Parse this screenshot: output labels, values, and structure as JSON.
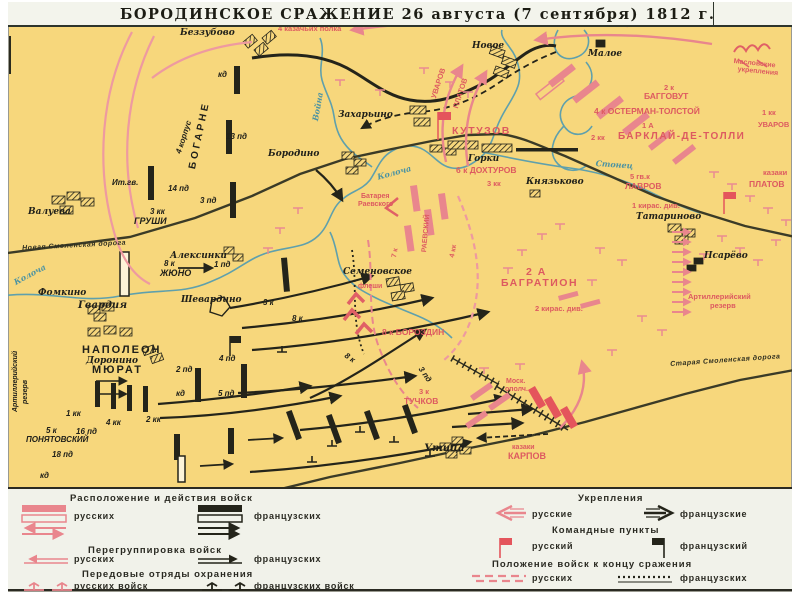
{
  "title": "БОРОДИНСКОЕ СРАЖЕНИЕ   26 августа (7 сентября) 1812 г.",
  "colors": {
    "map_background": "#f7d77c",
    "russian_pink": "#e9868d",
    "russian_red_text": "#dd5a60",
    "french_black": "#24241a",
    "river_blue": "#5fa0ac"
  },
  "legend": {
    "left": {
      "h1": "Расположение и действия войск",
      "rus1": "русских",
      "fr1": "французских",
      "h2": "Перегруппировка войск",
      "rus2": "русских",
      "fr2": "французских",
      "h3": "Передовые отряды охранения",
      "rus3": "русских войск",
      "fr3": "французских войск"
    },
    "right": {
      "h1": "Укрепления",
      "rus1": "русские",
      "fr1": "французские",
      "h2": "Командные пункты",
      "rus2": "русский",
      "fr2": "французский",
      "h3": "Положение войск к концу сражения",
      "rus3": "русских",
      "fr3": "французских"
    }
  },
  "map_labels": [
    {
      "t": "Беззубово",
      "x": 180,
      "y": 28,
      "c": "v"
    },
    {
      "t": "Новое",
      "x": 472,
      "y": 41,
      "c": "v"
    },
    {
      "t": "Малое",
      "x": 588,
      "y": 49,
      "c": "v"
    },
    {
      "t": "Захарьино",
      "x": 338,
      "y": 110,
      "c": "v"
    },
    {
      "t": "Бородино",
      "x": 268,
      "y": 149,
      "c": "v"
    },
    {
      "t": "Валуева",
      "x": 28,
      "y": 207,
      "c": "v"
    },
    {
      "t": "Горки",
      "x": 468,
      "y": 154,
      "c": "v"
    },
    {
      "t": "Князьково",
      "x": 526,
      "y": 177,
      "c": "v"
    },
    {
      "t": "Татариново",
      "x": 636,
      "y": 212,
      "c": "v"
    },
    {
      "t": "Псарёво",
      "x": 704,
      "y": 251,
      "c": "v"
    },
    {
      "t": "Алексинки",
      "x": 170,
      "y": 251,
      "c": "v"
    },
    {
      "t": "Фомкино",
      "x": 38,
      "y": 288,
      "c": "v"
    },
    {
      "t": "Семеновское",
      "x": 343,
      "y": 267,
      "c": "v"
    },
    {
      "t": "Доронино",
      "x": 86,
      "y": 356,
      "c": "v"
    },
    {
      "t": "Шевардино",
      "x": 181,
      "y": 295,
      "c": "v"
    },
    {
      "t": "Утица",
      "x": 424,
      "y": 443,
      "c": "v",
      "s": 10
    },
    {
      "t": "Гвардия",
      "x": 78,
      "y": 300,
      "c": "v",
      "s": 10
    },
    {
      "t": "Ит.гв.",
      "x": 112,
      "y": 178,
      "c": "u"
    },
    {
      "t": "кд",
      "x": 218,
      "y": 70,
      "c": "u"
    },
    {
      "t": "13 пд",
      "x": 226,
      "y": 132,
      "c": "u"
    },
    {
      "t": "14 пд",
      "x": 168,
      "y": 184,
      "c": "u"
    },
    {
      "t": "3 пд",
      "x": 200,
      "y": 196,
      "c": "u"
    },
    {
      "t": "3 кк",
      "x": 150,
      "y": 207,
      "c": "u"
    },
    {
      "t": "ГРУШИ",
      "x": 134,
      "y": 216,
      "c": "u",
      "s": 9
    },
    {
      "t": "1 пд",
      "x": 214,
      "y": 260,
      "c": "u"
    },
    {
      "t": "8 к",
      "x": 164,
      "y": 259,
      "c": "u"
    },
    {
      "t": "ЖЮНО",
      "x": 160,
      "y": 268,
      "c": "u",
      "s": 9
    },
    {
      "t": "НАПОЛЕОН",
      "x": 82,
      "y": 345,
      "c": "U"
    },
    {
      "t": "МЮРАТ",
      "x": 92,
      "y": 365,
      "c": "U"
    },
    {
      "t": "2 пд",
      "x": 176,
      "y": 365,
      "c": "u"
    },
    {
      "t": "кд",
      "x": 176,
      "y": 389,
      "c": "u"
    },
    {
      "t": "1 кк",
      "x": 66,
      "y": 409,
      "c": "u"
    },
    {
      "t": "4 кк",
      "x": 106,
      "y": 418,
      "c": "u"
    },
    {
      "t": "2 кк",
      "x": 146,
      "y": 415,
      "c": "u"
    },
    {
      "t": "5 к",
      "x": 46,
      "y": 426,
      "c": "u"
    },
    {
      "t": "ПОНЯТОВСКИЙ",
      "x": 26,
      "y": 435,
      "c": "u"
    },
    {
      "t": "16 пд",
      "x": 76,
      "y": 427,
      "c": "u"
    },
    {
      "t": "18 пд",
      "x": 52,
      "y": 450,
      "c": "u"
    },
    {
      "t": "кд",
      "x": 40,
      "y": 471,
      "c": "u"
    },
    {
      "t": "3 к",
      "x": 263,
      "y": 298,
      "c": "u"
    },
    {
      "t": "8 к",
      "x": 292,
      "y": 314,
      "c": "u"
    },
    {
      "t": "8 к",
      "x": 348,
      "y": 351,
      "c": "u",
      "r": 35
    },
    {
      "t": "4 пд",
      "x": 219,
      "y": 354,
      "c": "u"
    },
    {
      "t": "5 пд",
      "x": 218,
      "y": 389,
      "c": "u"
    },
    {
      "t": "3 пд",
      "x": 424,
      "y": 365,
      "c": "u",
      "r": 55
    },
    {
      "t": "Артиллерийский",
      "x": 12,
      "y": 412,
      "c": "uv",
      "r": -90
    },
    {
      "t": "резерв",
      "x": 22,
      "y": 404,
      "c": "uv",
      "r": -90
    },
    {
      "t": "4 корпус",
      "x": 174,
      "y": 152,
      "c": "u",
      "r": -72
    },
    {
      "t": "БОГАРНЕ",
      "x": 188,
      "y": 168,
      "c": "U2",
      "r": -78
    },
    {
      "t": "4 казачьих полка",
      "x": 278,
      "y": 25,
      "c": "r"
    },
    {
      "t": "УВАРОВ",
      "x": 430,
      "y": 97,
      "c": "r",
      "r": -72
    },
    {
      "t": "ПЛАТОВ",
      "x": 452,
      "y": 107,
      "c": "r",
      "r": -72
    },
    {
      "t": "Масловские",
      "x": 734,
      "y": 58,
      "c": "r",
      "s": 7,
      "r": 6
    },
    {
      "t": "укрепления",
      "x": 738,
      "y": 66,
      "c": "r",
      "s": 7,
      "r": 6
    },
    {
      "t": "1 кк",
      "x": 762,
      "y": 109,
      "c": "r"
    },
    {
      "t": "УВАРОВ",
      "x": 758,
      "y": 121,
      "c": "r"
    },
    {
      "t": "2 к",
      "x": 664,
      "y": 84,
      "c": "r"
    },
    {
      "t": "БАГГОВУТ",
      "x": 644,
      "y": 92,
      "c": "r",
      "s": 8.5
    },
    {
      "t": "4 к ОСТЕРМАН-ТОЛСТОЙ",
      "x": 594,
      "y": 107,
      "c": "r",
      "s": 8.5
    },
    {
      "t": "1 А",
      "x": 642,
      "y": 122,
      "c": "r"
    },
    {
      "t": "БАРКЛАЙ-ДЕ-ТОЛЛИ",
      "x": 618,
      "y": 132,
      "c": "R",
      "s": 10
    },
    {
      "t": "2 кк",
      "x": 591,
      "y": 134,
      "c": "r"
    },
    {
      "t": "КУТУЗОВ",
      "x": 452,
      "y": 126,
      "c": "R"
    },
    {
      "t": "6 к ДОХТУРОВ",
      "x": 456,
      "y": 166,
      "c": "r",
      "s": 8.5
    },
    {
      "t": "3 кк",
      "x": 487,
      "y": 180,
      "c": "r"
    },
    {
      "t": "5 гв.к",
      "x": 630,
      "y": 173,
      "c": "r"
    },
    {
      "t": "ЛАВРОВ",
      "x": 625,
      "y": 182,
      "c": "r",
      "s": 8.5
    },
    {
      "t": "казаки",
      "x": 763,
      "y": 169,
      "c": "r"
    },
    {
      "t": "ПЛАТОВ",
      "x": 749,
      "y": 180,
      "c": "r",
      "s": 8.5
    },
    {
      "t": "1 кирас. див.",
      "x": 632,
      "y": 202,
      "c": "r"
    },
    {
      "t": "2 А",
      "x": 526,
      "y": 267,
      "c": "R"
    },
    {
      "t": "БАГРАТИОН",
      "x": 501,
      "y": 278,
      "c": "R"
    },
    {
      "t": "2 кирас. див.",
      "x": 535,
      "y": 305,
      "c": "r"
    },
    {
      "t": "8 к БОРОЗДИН",
      "x": 382,
      "y": 328,
      "c": "r",
      "s": 8.5
    },
    {
      "t": "Батарея",
      "x": 361,
      "y": 193,
      "c": "r",
      "s": 7
    },
    {
      "t": "Раевского",
      "x": 358,
      "y": 201,
      "c": "r",
      "s": 7
    },
    {
      "t": "РАЕВСКИЙ",
      "x": 421,
      "y": 252,
      "c": "r",
      "r": -85,
      "s": 7
    },
    {
      "t": "7 к",
      "x": 391,
      "y": 257,
      "c": "r",
      "r": -80,
      "s": 7
    },
    {
      "t": "4 кк",
      "x": 449,
      "y": 257,
      "c": "r",
      "r": -80,
      "s": 7
    },
    {
      "t": "флеши",
      "x": 358,
      "y": 283,
      "c": "r",
      "s": 7
    },
    {
      "t": "3 к",
      "x": 419,
      "y": 388,
      "c": "r"
    },
    {
      "t": "ТУЧКОВ",
      "x": 404,
      "y": 397,
      "c": "r",
      "s": 8.5
    },
    {
      "t": "Моск.",
      "x": 506,
      "y": 378,
      "c": "r",
      "s": 7
    },
    {
      "t": "ополч.",
      "x": 505,
      "y": 386,
      "c": "r",
      "s": 7
    },
    {
      "t": "казаки",
      "x": 512,
      "y": 444,
      "c": "r",
      "s": 7
    },
    {
      "t": "КАРПОВ",
      "x": 508,
      "y": 452,
      "c": "r",
      "s": 9
    },
    {
      "t": "Артиллерийский",
      "x": 688,
      "y": 293,
      "c": "r"
    },
    {
      "t": "резерв",
      "x": 710,
      "y": 302,
      "c": "r"
    },
    {
      "t": "Колоча",
      "x": 12,
      "y": 278,
      "c": "b",
      "r": -28
    },
    {
      "t": "Война",
      "x": 310,
      "y": 120,
      "c": "b",
      "r": -80
    },
    {
      "t": "Колоча",
      "x": 376,
      "y": 172,
      "c": "b",
      "r": -15
    },
    {
      "t": "Стонец",
      "x": 596,
      "y": 158,
      "c": "b",
      "r": 4
    },
    {
      "t": "Новая Смоленская дорога",
      "x": 22,
      "y": 245,
      "c": "d",
      "r": -3
    },
    {
      "t": "Старая Смоленская дорога",
      "x": 670,
      "y": 361,
      "c": "d",
      "r": -4
    }
  ]
}
